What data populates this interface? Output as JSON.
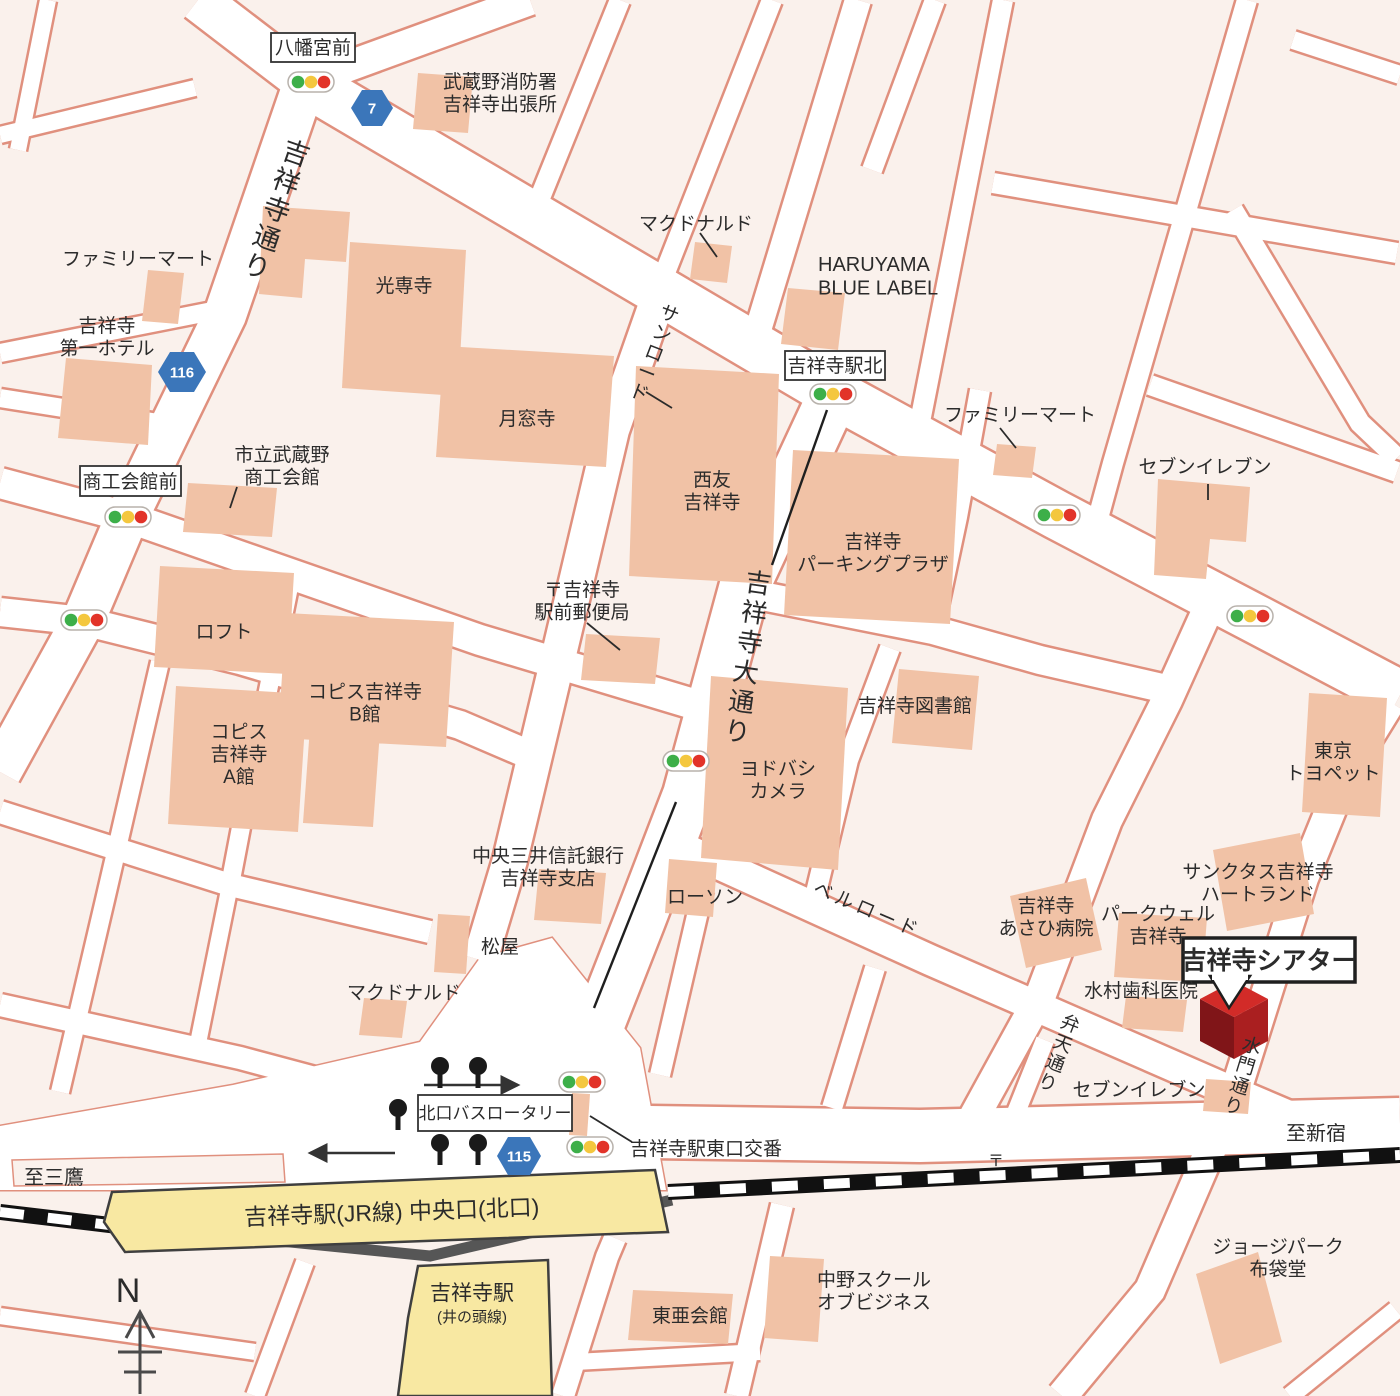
{
  "colors": {
    "background": "#faf1ec",
    "road_fill": "#ffffff",
    "road_casing": "#e0907e",
    "building": "#f1c2a6",
    "station_building": "#f8e8a2",
    "railway": "#111111",
    "theatre_top": "#d22b28",
    "theatre_left": "#801518",
    "theatre_right": "#aa1f20",
    "badge_blue": "#3b76ba",
    "signal_green": "#3daf49",
    "signal_yellow": "#f4c73e",
    "signal_red": "#e23329",
    "text": "#2b2b2b"
  },
  "roads": {
    "kichijoji_dori": "吉祥寺通り",
    "sunroad": "サンロード",
    "odori": "吉祥寺大通り",
    "bellroad": "ベルロード",
    "benten_dori": "弁天通り",
    "suimon_dori": "水門通り"
  },
  "route_badges": {
    "r7": "7",
    "r116": "116",
    "r115": "115"
  },
  "boxed_labels": {
    "hachimangu_mae": "八幡宮前",
    "kichijoji_eki_kita": "吉祥寺駅北",
    "shoko_kaikan_mae": "商工会館前",
    "bus_rotary": "北口バスロータリー"
  },
  "places": {
    "fire_station": {
      "text": "武蔵野消防署\n吉祥寺出張所"
    },
    "mcdonalds_top": {
      "text": "マクドナルド"
    },
    "haruyama": {
      "text": "HARUYAMA\nBLUE LABEL"
    },
    "familymart_tl": {
      "text": "ファミリーマート"
    },
    "daiichi_hotel": {
      "text": "吉祥寺\n第一ホテル"
    },
    "kosenji": {
      "text": "光専寺"
    },
    "gessoji": {
      "text": "月窓寺"
    },
    "familymart_right": {
      "text": "ファミリーマート"
    },
    "seveneleven_top": {
      "text": "セブンイレブン"
    },
    "shoko_kaikan": {
      "text": "市立武蔵野\n商工会館"
    },
    "post_office": {
      "text": "〒吉祥寺\n駅前郵便局"
    },
    "loft": {
      "text": "ロフト"
    },
    "coppice_b": {
      "text": "コピス吉祥寺\nB館"
    },
    "coppice_a": {
      "text": "コピス\n吉祥寺\nA館"
    },
    "seiyu": {
      "text": "西友\n吉祥寺"
    },
    "parking_plaza": {
      "text": "吉祥寺\nパーキングプラザ"
    },
    "library": {
      "text": "吉祥寺図書館"
    },
    "toyopet": {
      "text": "東京\nトヨペット"
    },
    "yodobashi": {
      "text": "ヨドバシ\nカメラ"
    },
    "chuo_mitsui": {
      "text": "中央三井信託銀行\n吉祥寺支店"
    },
    "lawson": {
      "text": "ローソン"
    },
    "matsuya": {
      "text": "松屋"
    },
    "mcdonalds_bottom": {
      "text": "マクドナルド"
    },
    "asahi_hospital": {
      "text": "吉祥寺\nあさひ病院"
    },
    "parkwell": {
      "text": "パークウェル\n吉祥寺"
    },
    "sanctus": {
      "text": "サンクタス吉祥寺\nハートランド"
    },
    "mizumura_dental": {
      "text": "水村歯科医院"
    },
    "seveneleven_bottom": {
      "text": "セブンイレブン"
    },
    "police_box": {
      "text": "吉祥寺駅東口交番"
    },
    "toa_kaikan": {
      "text": "東亜会館"
    },
    "nakano_school": {
      "text": "中野スクール\nオブビジネス"
    },
    "george_park": {
      "text": "ジョージパーク\n布袋堂"
    }
  },
  "theatre": {
    "name": "吉祥寺シアター"
  },
  "stations": {
    "jr": {
      "name": "吉祥寺駅(JR線) 中央口(北口)"
    },
    "inokashira": {
      "name": "吉祥寺駅",
      "line": "(井の頭線)"
    }
  },
  "directions": {
    "mitaka": "至三鷹",
    "shinjuku": "至新宿",
    "north": "N"
  },
  "postal_mark": "〒"
}
